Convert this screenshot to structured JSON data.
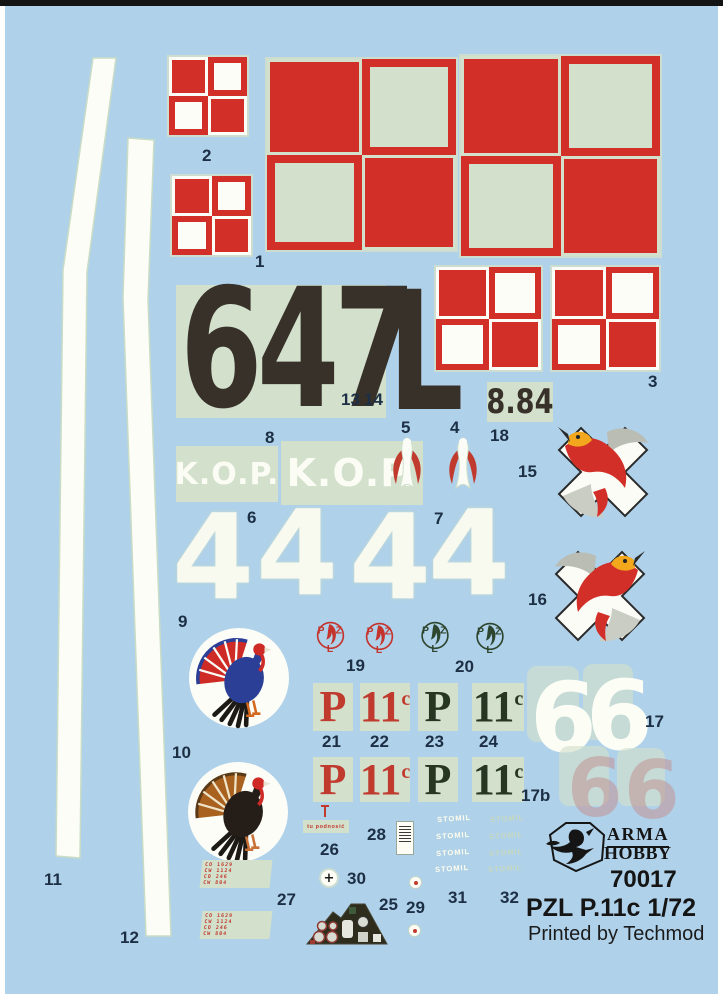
{
  "sheet": {
    "brand_line1": "ARMA",
    "brand_line2": "HOBBY",
    "product_code": "70017",
    "product_title": "PZL P.11c 1/72",
    "printed_by": "Printed by Techmod"
  },
  "decals": {
    "serial_number": "647",
    "serial_letter": "L",
    "date_code": "8.84",
    "kop": "K.O.P.",
    "digit4": "4",
    "digit6": "6",
    "type_p": "P",
    "type_11": "11",
    "type_sup": "c",
    "stomil": "STOMIL",
    "pzl_p": "P",
    "pzl_z": "Z",
    "pzl_l": "L",
    "cross_mark": "+",
    "stencil26": "tu podnosić",
    "stencil27": [
      "CO 1629",
      "CW 1124",
      "CO 246",
      "CW 804"
    ]
  },
  "labels": {
    "p1": "1",
    "p2": "2",
    "p3": "3",
    "p4": "4",
    "p5": "5",
    "p6": "6",
    "p7": "7",
    "p8": "8",
    "p9": "9",
    "p10": "10",
    "p11": "11",
    "p12": "12",
    "p13": "13",
    "p14": "14",
    "p15": "15",
    "p16": "16",
    "p17": "17",
    "p17b": "17b",
    "p18": "18",
    "p19": "19",
    "p20": "20",
    "p21": "21",
    "p22": "22",
    "p23": "23",
    "p24": "24",
    "p25": "25",
    "p26": "26",
    "p27": "27",
    "p28": "28",
    "p29": "29",
    "p30": "30",
    "p31": "31",
    "p32": "32"
  },
  "colors": {
    "background": "#afd1e9",
    "decal_film": "#d2e0cc",
    "insignia_red": "#d22f28",
    "serial_black": "#38312a",
    "label_navy": "#1c2f45",
    "pzl_green": "#2e4630",
    "brand_black": "#151515"
  }
}
